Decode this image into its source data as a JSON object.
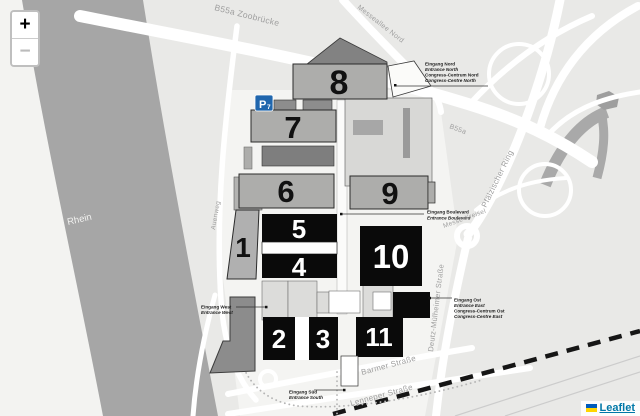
{
  "controls": {
    "zoom_in": "+",
    "zoom_out": "−"
  },
  "attribution": {
    "flag_icon": "ukraine-flag-icon",
    "label": "Leaflet"
  },
  "river": {
    "rhein": "Rhein"
  },
  "streets": {
    "zoobruecke": "B55a Zoobrücke",
    "messeallee_nord": "Messeallee Nord",
    "b55a": "B55a",
    "pfaelzischer_ring": "Pfälzischer Ring",
    "messe_kreisel": "Messe-Kreisel",
    "deutz_muelheimer": "Deutz-Mülheimer Straße",
    "barmer": "Barmer Straße",
    "lenneper": "Lenneper Straße",
    "auenweg": "Auenweg"
  },
  "halls": {
    "h1": "1",
    "h2": "2",
    "h3": "3",
    "h4": "4",
    "h5": "5",
    "h6": "6",
    "h7": "7",
    "h8": "8",
    "h9": "9",
    "h10": "10",
    "h11": "11"
  },
  "parking": {
    "letter": "P",
    "number": "7"
  },
  "entrances": {
    "north": {
      "l1": "Eingang Nord",
      "l2": "Entrance North",
      "l3": "Congress-Centrum Nord",
      "l4": "Congress-Centre North"
    },
    "boulevard": {
      "l1": "Eingang Boulevard",
      "l2": "Entrance Boulevard"
    },
    "west": {
      "l1": "Eingang West",
      "l2": "Entrance West"
    },
    "east": {
      "l1": "Eingang Ost",
      "l2": "Entrance East",
      "l3": "Congress-Centrum Ost",
      "l4": "Congress-Centre East"
    },
    "south": {
      "l1": "Eingang Süd",
      "l2": "Entrance South"
    }
  },
  "colors": {
    "background": "#e9e9e7",
    "river": "#a6a6a6",
    "hall_gray": "#adadab",
    "hall_black": "#0a0a0a",
    "parking_blue": "#2066ad",
    "leaflet_link": "#0078A8"
  }
}
